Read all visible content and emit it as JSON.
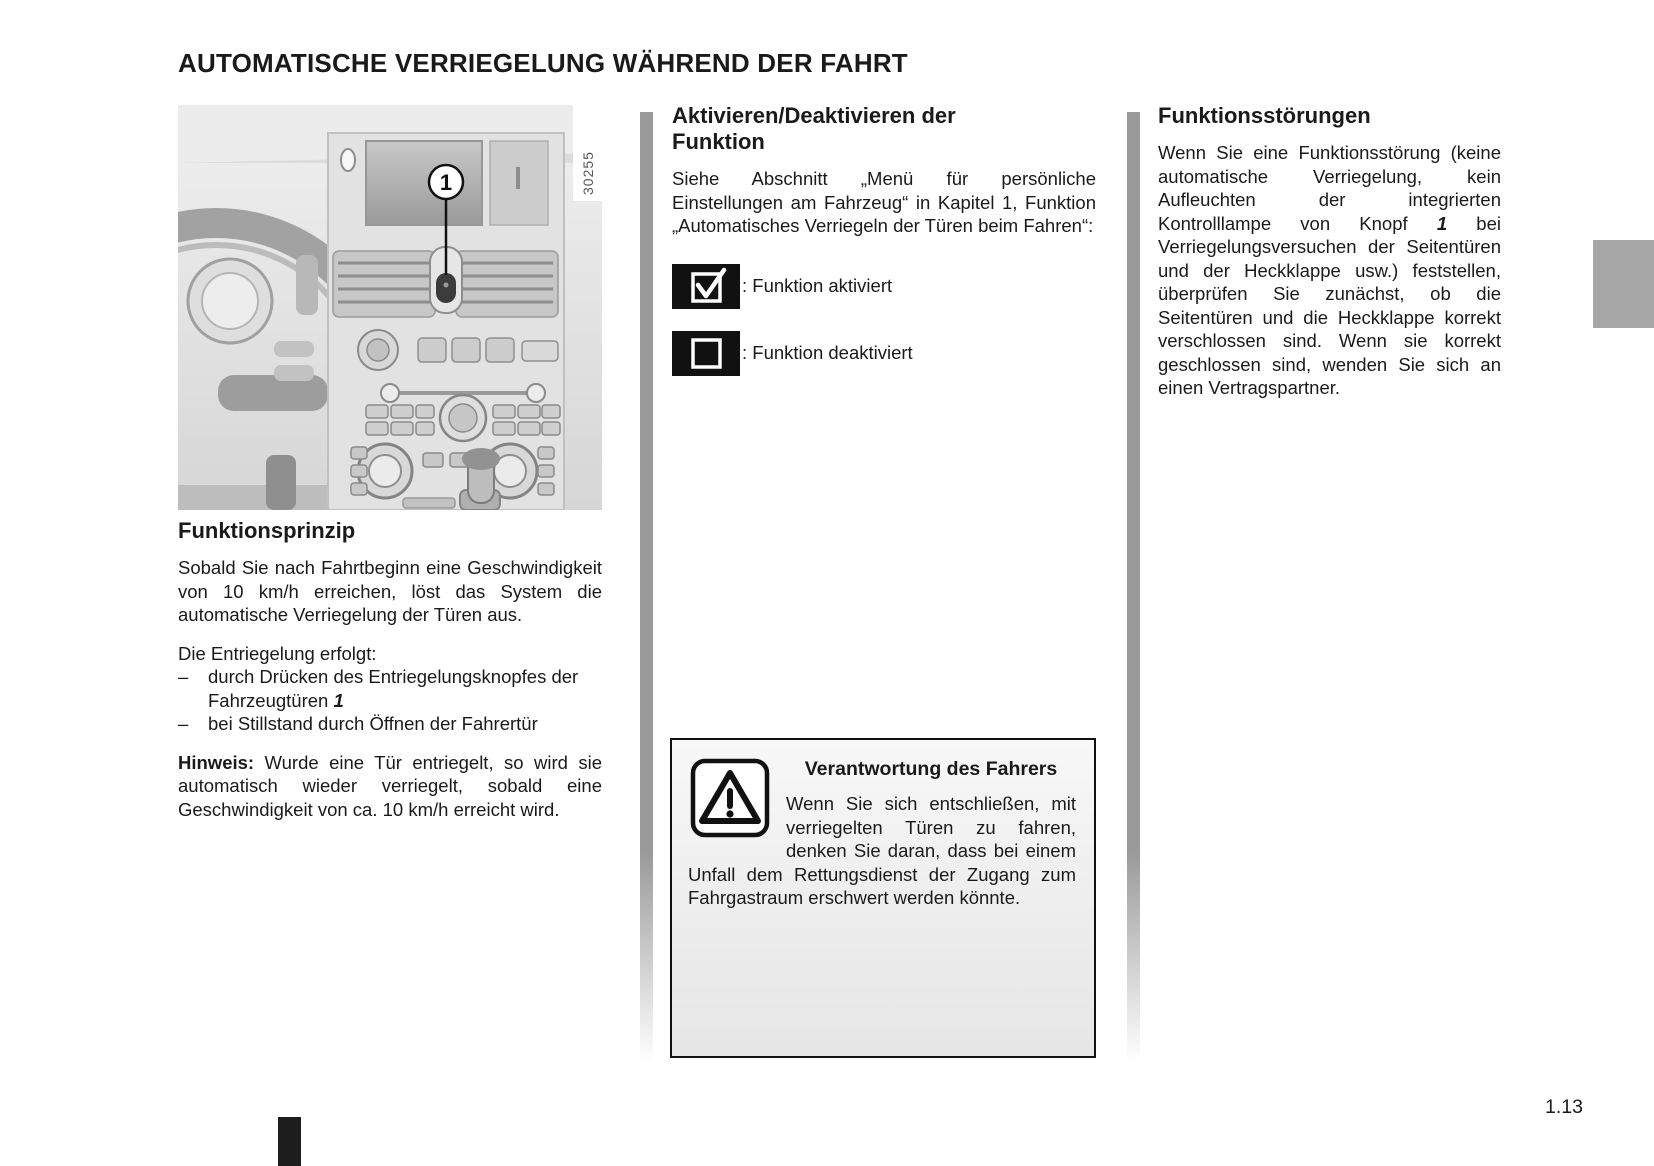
{
  "page": {
    "title": "AUTOMATISCHE VERRIEGELUNG WÄHREND DER FAHRT",
    "page_number": "1.13"
  },
  "figure": {
    "photo_ref": "30255",
    "callout_label": "1"
  },
  "left": {
    "heading": "Funktionsprinzip",
    "para1": "Sobald Sie nach Fahrtbeginn eine Geschwindigkeit von 10 km/h erreichen, löst das System die automatische Verriegelung der Türen aus.",
    "list_intro": "Die Entriegelung erfolgt:",
    "bullets": [
      {
        "dash": "–",
        "text": "durch Drücken des Entriegelungsknopfes der Fahrzeugtüren ",
        "ref": "1"
      },
      {
        "dash": "–",
        "text": "bei Stillstand durch Öffnen der Fahrertür",
        "ref": ""
      }
    ],
    "note_label": "Hinweis:",
    "note_text": " Wurde eine Tür entriegelt, so wird sie automatisch wieder verriegelt, sobald eine Geschwindigkeit von ca. 10 km/h erreicht wird."
  },
  "middle": {
    "heading": "Aktivieren/Deaktivieren der Funktion",
    "para1": "Siehe Abschnitt „Menü für persönliche Einstellungen am Fahrzeug“ in Kapitel 1, Funktion „Automatisches Verriegeln der Türen beim Fahren“:",
    "option_on_label": ": Funktion aktiviert",
    "option_off_label": ": Funktion deaktiviert",
    "warning": {
      "heading": "Verantwortung des Fahrers",
      "text": "Wenn Sie sich entschließen, mit verriegelten Türen zu fahren, denken Sie daran, dass bei einem Unfall dem Rettungsdienst der Zugang zum Fahrgastraum erschwert werden könnte."
    }
  },
  "right": {
    "heading": "Funktionsstörungen",
    "para_part1": "Wenn Sie eine Funktionsstörung (keine automatische Verriegelung, kein Aufleuchten der integrierten Kontrolllampe von Knopf ",
    "knopf_ref": "1",
    "para_part2": " bei Verriegelungsversuchen der Seitentüren und der Heckklappe usw.) feststellen, überprüfen Sie zunächst, ob die Seitentüren und die Heckklappe korrekt verschlossen sind. Wenn sie korrekt geschlossen sind, wenden Sie sich an einen Vertragspartner."
  }
}
